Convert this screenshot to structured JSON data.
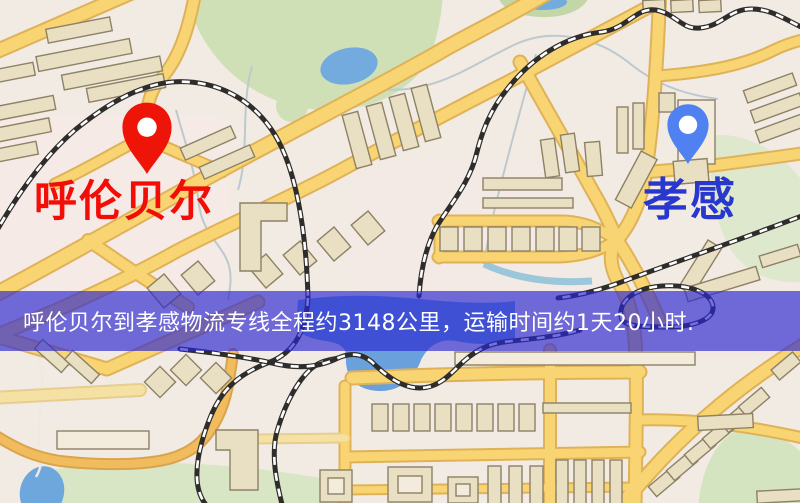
{
  "banner": {
    "text": "呼伦贝尔到孝感物流专线全程约3148公里，运输时间约1天20小时.",
    "text_color": "#ffffff",
    "background_color": "#2b26d2"
  },
  "route": {
    "origin": "呼伦贝尔",
    "destination": "孝感",
    "distance_text": "约3148公里",
    "duration_text": "约1天20小时"
  },
  "markers": {
    "origin": {
      "label": "呼伦贝尔",
      "pin_color": "#ee1408",
      "label_color": "#f20d06"
    },
    "destination": {
      "label": "孝感",
      "pin_color": "#4f82f0",
      "label_color": "#2837cd"
    }
  },
  "map_colors": {
    "background": "#f2ebe4",
    "road_fill": "#f8d572",
    "road_casing": "#e0b258",
    "building_fill": "#e9dfc2",
    "building_stroke": "#8d8166",
    "park_green": "#cfe0b6",
    "pale_green": "#dde8cc",
    "water_blue": "#74abdf",
    "railway": "#2e2d2b"
  }
}
